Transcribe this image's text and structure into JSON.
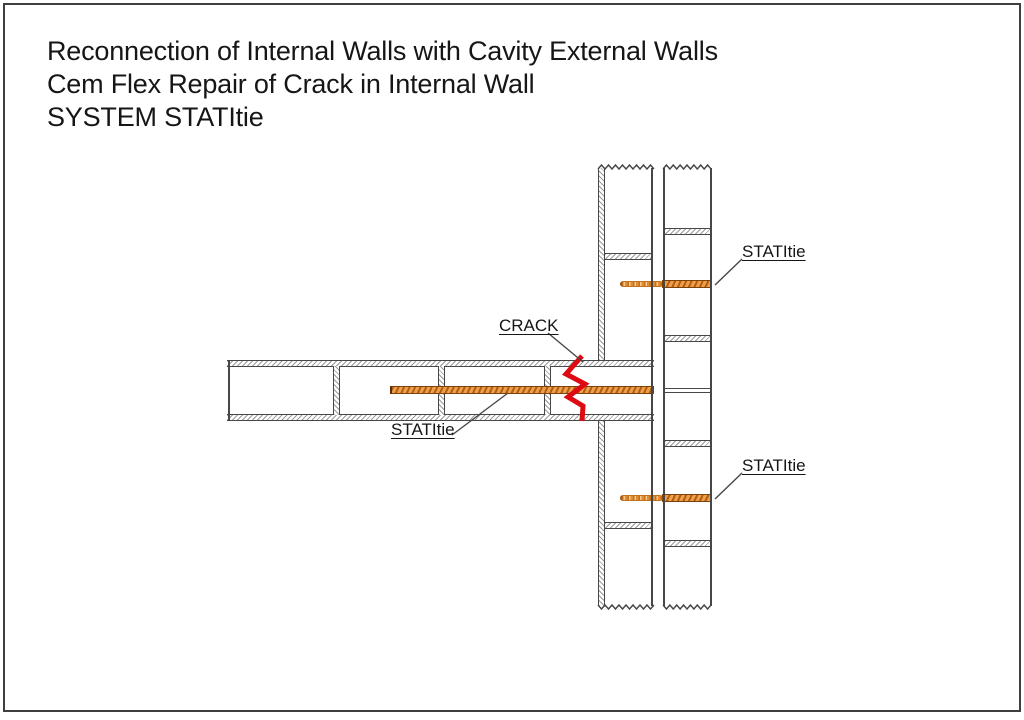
{
  "title": {
    "line1": "Reconnection of Internal Walls with Cavity External Walls",
    "line2": "Cem Flex Repair of Crack in Internal Wall",
    "line3": "SYSTEM STATItie"
  },
  "labels": {
    "crack": "CRACK",
    "tie_internal": "STATItie",
    "tie_upper": "STATItie",
    "tie_lower": "STATItie"
  },
  "colors": {
    "line_gray": "#474747",
    "hatch_gray": "#9a9a9a",
    "tie_orange": "#f09e4a",
    "tie_dark": "#ad5f14",
    "tie_border": "#7c4208",
    "crack_red": "#dd0a14",
    "text_black": "#161616"
  }
}
